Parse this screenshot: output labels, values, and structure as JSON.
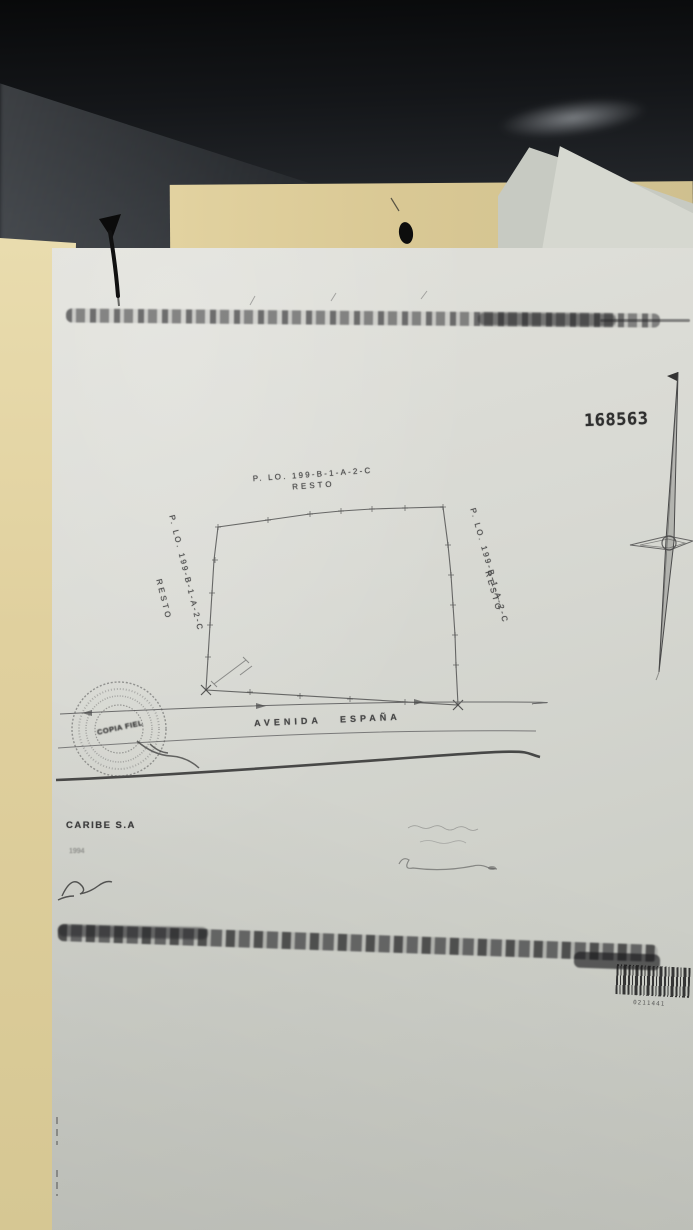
{
  "scene": {
    "type": "photographed survey plan on desk",
    "colors": {
      "desk": "#1b1d20",
      "folder": "#d9c894",
      "paper": "#d8d9d3",
      "ink": "#4c4c4c"
    }
  },
  "document": {
    "registry_number": "168563",
    "parcels": {
      "top": {
        "id": "P. LO. 199-B-1-A-2-C",
        "note": "RESTO"
      },
      "left": {
        "id": "P. LO. 199-B-1-A-2-C",
        "note": "RESTO"
      },
      "right": {
        "id": "P. LO. 199-B-1-A-2-C",
        "note": "RESTO"
      }
    },
    "street": {
      "label": "AVENIDA ESPAÑA"
    },
    "seal": {
      "center_text": "COPIA FIEL"
    },
    "footer": {
      "company": "CARIBE S.A",
      "sub": "1994"
    },
    "barcode": {
      "digits": "0211441"
    }
  }
}
